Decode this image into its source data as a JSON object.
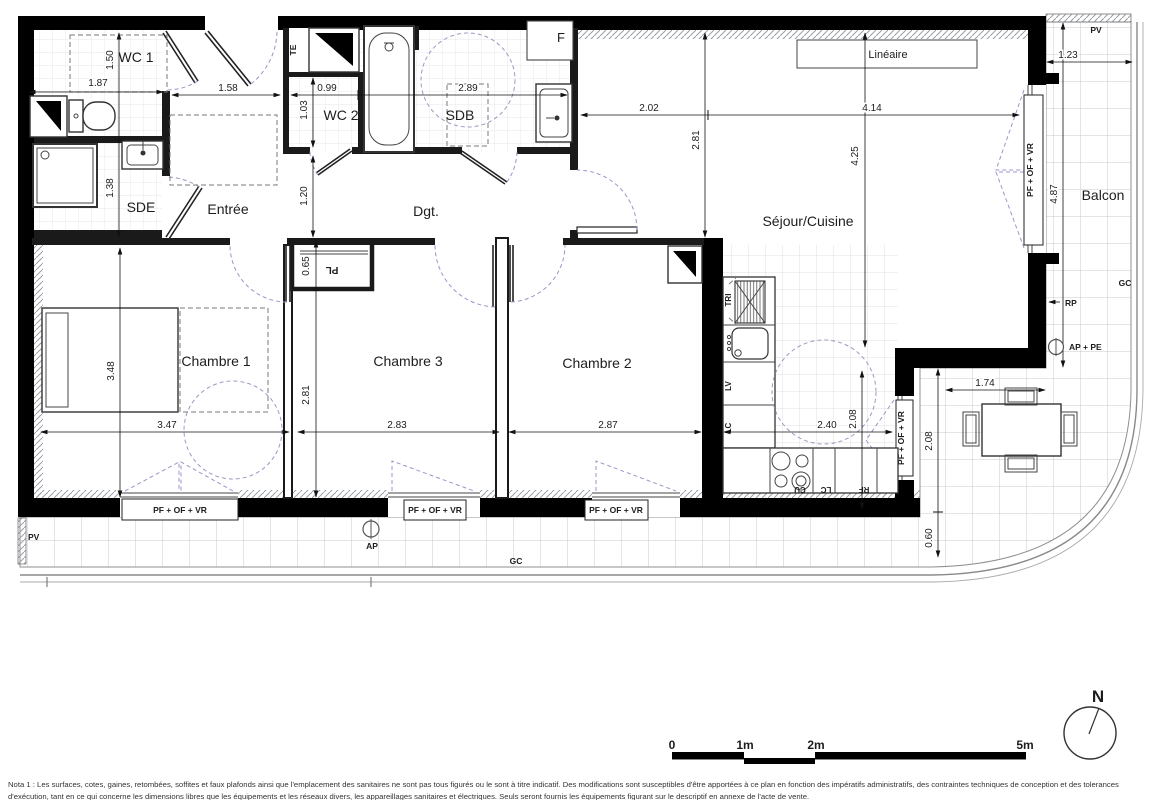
{
  "plan": {
    "rooms": {
      "wc1": "WC 1",
      "sde": "SDE",
      "entree": "Entrée",
      "wc2": "WC 2",
      "sdb": "SDB",
      "dgt": "Dgt.",
      "sejour": "Séjour/Cuisine",
      "ch1": "Chambre 1",
      "ch3": "Chambre 3",
      "ch2": "Chambre 2",
      "balcon": "Balcon"
    },
    "labels": {
      "te": "TE",
      "f": "F",
      "pl": "PL",
      "lineaire": "Linéaire",
      "tri": "TRI",
      "lv": "LV",
      "lc": "LC",
      "cu": "CU",
      "rf": "RF",
      "window": "PF + OF + VR",
      "pv": "PV",
      "gc": "GC",
      "rp": "RP",
      "ap": "AP",
      "ap_pe": "AP + PE"
    },
    "dims": {
      "wc1_w": "1.87",
      "wc1_h": "1.50",
      "sde_h": "1.38",
      "entree_w": "1.58",
      "wc2_w": "0.99",
      "wc2_h": "1.03",
      "sdb_w": "2.89",
      "dgt_h": "1.20",
      "sejour_w1": "2.02",
      "sejour_w2": "4.14",
      "sejour_h1": "2.81",
      "sejour_h2": "4.25",
      "balcon_w": "1.23",
      "balcon_h": "4.87",
      "ch1_h": "3.48",
      "ch1_w": "3.47",
      "pl_h": "0.65",
      "ch3_h": "2.81",
      "ch3_w": "2.83",
      "ch2_w": "2.87",
      "kitchen_w": "2.40",
      "kitchen_win_h": "2.08",
      "balcon_s": "2.08",
      "balcon_e": "0.60",
      "table_w": "1.74"
    },
    "scale": {
      "t0": "0",
      "t1": "1m",
      "t2": "2m",
      "t5": "5m"
    },
    "north": "N",
    "nota": "Nota 1 : Les surfaces, cotes, gaines, retombées, soffites et faux plafonds ainsi que l'emplacement des sanitaires ne sont pas tous figurés ou le sont à titre indicatif. Des modifications sont susceptibles d'être apportées à ce plan en fonction des impératifs administratifs, des contraintes techniques de conception et des tolerances d'exécution, tant en ce qui concerne les dimensions libres que les équipements et les réseaux divers, les appareillages sanitaires et électriques. Seuls seront fournis les équipements figurant sur le descriptif en annexe de l'acte de vente."
  }
}
